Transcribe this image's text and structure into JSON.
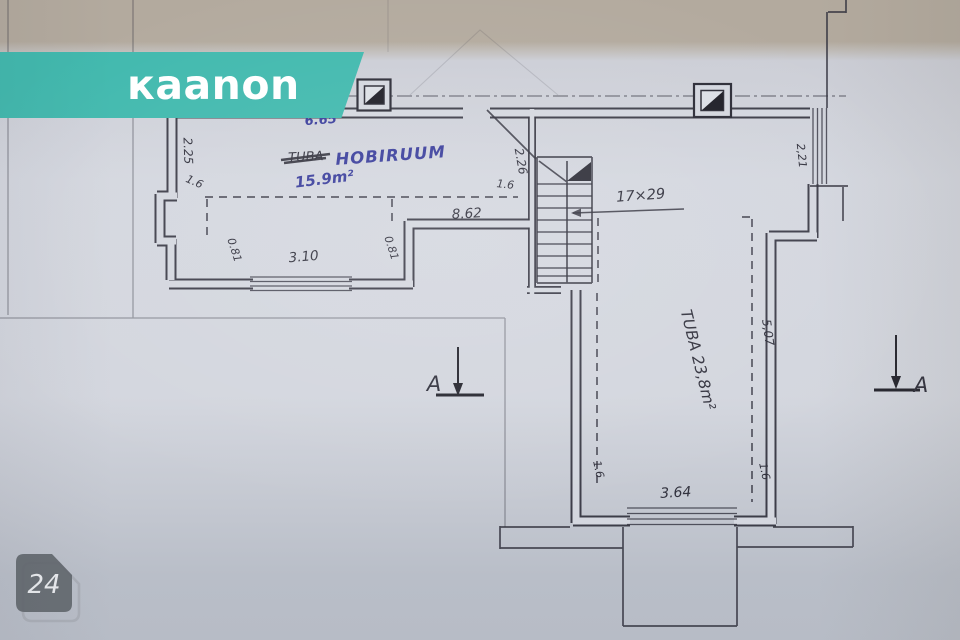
{
  "brand": {
    "logo_text": "каanon",
    "banner_color": "#41b9ae"
  },
  "photo_badge": {
    "number": "24"
  },
  "plan": {
    "room1": {
      "struck_name": "TUBA",
      "name": "HOBIRUUM",
      "area": "15.9m²"
    },
    "room2": {
      "label": "TUBA 23,8m²"
    },
    "stairs_label": "17×29",
    "section_left": "A",
    "section_right": "A",
    "dims": {
      "top_width": "6.65",
      "left_height": "2.25",
      "left_step": "1.6",
      "left_jamb": "0.81",
      "window1": "3.10",
      "right_jamb": "0.81",
      "inner_width": "8.62",
      "door_width": "1.6",
      "door_depth": "2.26",
      "right_window": "2,21",
      "right_depth": "5,07",
      "room2_left_jamb": "1.6",
      "room2_right_jamb": "1.6",
      "window2": "3.64"
    }
  }
}
